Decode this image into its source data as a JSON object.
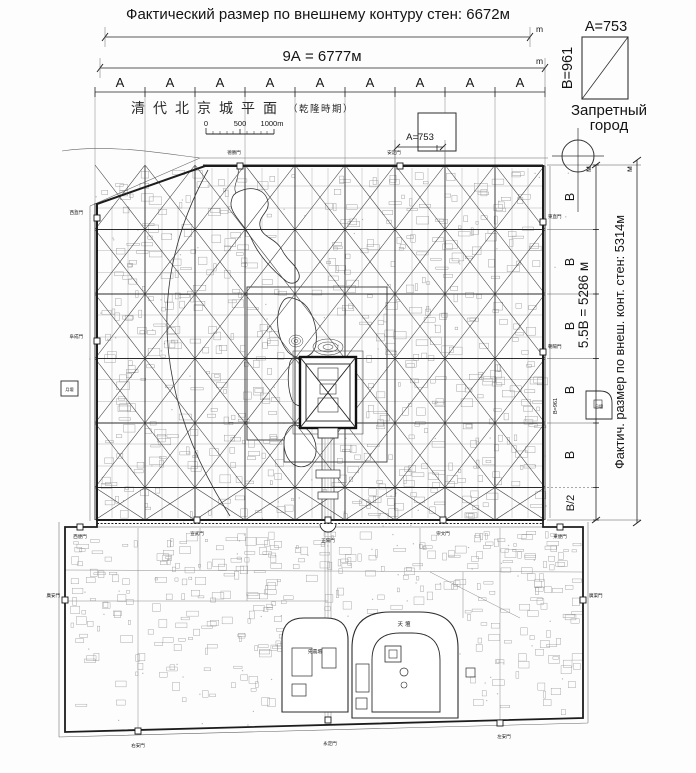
{
  "header": {
    "dim_actual": "Фактический размер по внешнему контуру стен: 6672м",
    "dim_modules": "9А = 6777м",
    "unit": "m",
    "unit_cyr": "м"
  },
  "legend": {
    "a": "А=753",
    "b": "В=961",
    "name1": "Запретный",
    "name2": "город"
  },
  "modules": {
    "count_cols": 9,
    "count_rows": 5,
    "col_label": "А",
    "row_label": "В",
    "half_row_label": "В/2"
  },
  "map": {
    "title_main": "清代北京城平面",
    "title_paren": "（乾隆時期）",
    "scale0": "0",
    "scale500": "500",
    "scale1000": "1000m",
    "dim_a": "А=753",
    "dim_b": "В=961",
    "gates": {
      "deshengmen": "德勝門",
      "andingmen": "安定門",
      "xizhimen": "西直門",
      "fuchengmen": "阜成門",
      "dongzhimen": "東直門",
      "chaoyangmen": "朝陽門",
      "xuanwumen": "宣武門",
      "zhengyangmen": "正陽門",
      "chongwenmen": "崇文門",
      "yongdingmen": "永定門",
      "youanmen": "右安門",
      "zuoanmen": "左安門",
      "guanganmen": "廣安門",
      "guangqumen": "廣渠門",
      "xibianmen": "西便門",
      "dongbianmen": "東便門"
    },
    "sites": {
      "heaven": "天壇",
      "agriculture": "先農壇",
      "moon": "月壇",
      "sun": "日壇"
    }
  },
  "right": {
    "dim_modules": "5.5В = 5286 м",
    "dim_actual": "Фактич. размер по внеш. конт. стен: 5314м"
  },
  "colors": {
    "ink": "#1c1c1c",
    "grid": "#2b2b2b",
    "faint": "#8a8a8a"
  }
}
